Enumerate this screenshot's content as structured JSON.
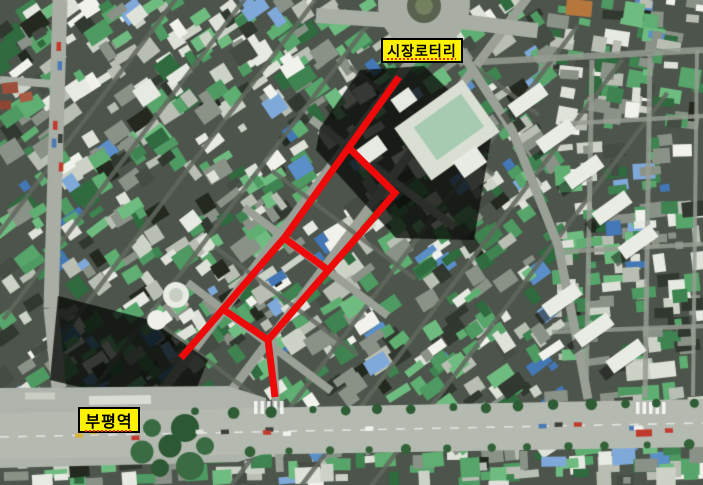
{
  "image": {
    "width": 703,
    "height": 485
  },
  "labels": {
    "rotary": {
      "text": "시장로터리"
    },
    "station": {
      "text": "부평역"
    }
  },
  "colors": {
    "annotation_red": "#ee0a0a",
    "label_background": "#fff200",
    "label_border": "#000000",
    "label_text": "#000000",
    "spellcheck_underline": "#ff2200"
  },
  "annotations": {
    "stroke_width": 7,
    "polylines": [
      {
        "name": "route-main-street",
        "points": [
          [
            399,
            77
          ],
          [
            285,
            237
          ],
          [
            181,
            358
          ]
        ]
      },
      {
        "name": "route-east-parallel-street",
        "points": [
          [
            348,
            147
          ],
          [
            395,
            193
          ],
          [
            268,
            340
          ],
          [
            275,
            397
          ]
        ]
      },
      {
        "name": "route-cross-street-middle",
        "points": [
          [
            284,
            238
          ],
          [
            328,
            270
          ]
        ]
      },
      {
        "name": "route-cross-street-south",
        "points": [
          [
            224,
            310
          ],
          [
            268,
            340
          ]
        ]
      }
    ]
  }
}
